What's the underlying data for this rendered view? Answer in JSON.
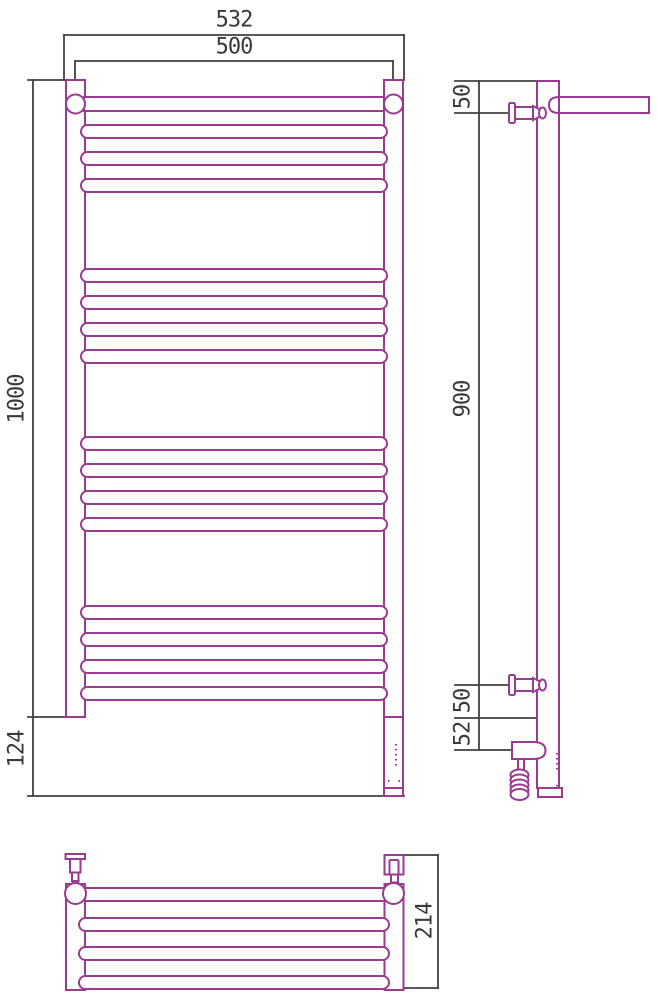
{
  "drawing_title": "heated-towel-rail-technical-drawing",
  "colors": {
    "drawing": "#993b8f",
    "dimension": "#404040",
    "text": "#3a3a3a",
    "background": "#ffffff"
  },
  "views": {
    "front": {
      "label": "front-view",
      "dimensions": [
        {
          "id": "overall-width",
          "value": "532",
          "unit": "mm"
        },
        {
          "id": "rail-center-width",
          "value": "500",
          "unit": "mm"
        },
        {
          "id": "overall-height",
          "value": "1000",
          "unit": "mm"
        },
        {
          "id": "lower-section-height",
          "value": "124",
          "unit": "mm"
        }
      ],
      "rung_groups": [
        4,
        4,
        4,
        4
      ]
    },
    "side": {
      "label": "side-view",
      "dimensions": [
        {
          "id": "top-to-upper-bracket",
          "value": "50",
          "unit": "mm"
        },
        {
          "id": "bracket-span",
          "value": "900",
          "unit": "mm"
        },
        {
          "id": "lower-bracket-to-base",
          "value": "50",
          "unit": "mm"
        },
        {
          "id": "base-to-heater-axis",
          "value": "52",
          "unit": "mm"
        }
      ]
    },
    "top": {
      "label": "top-view",
      "dimensions": [
        {
          "id": "overall-depth",
          "value": "214",
          "unit": "mm"
        }
      ]
    }
  }
}
